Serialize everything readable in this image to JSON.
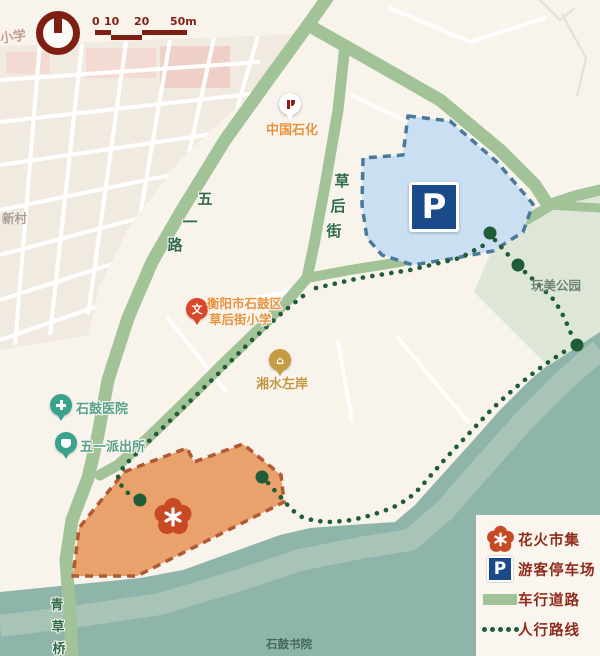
{
  "map_title": "花火市集导览图",
  "compass": {
    "icon": "north-compass"
  },
  "scale_bar": {
    "ticks": [
      "0",
      "10",
      "20",
      "50m"
    ]
  },
  "roads": {
    "wuyi_road": "五一路",
    "caohou_street": "草后街",
    "qingcao_bridge": "青草桥"
  },
  "places": {
    "sinopec": "中国石化",
    "school_line1": "衡阳市石鼓区",
    "school_line2": "草后街小学",
    "riverside_residence": "湘水左岸",
    "hospital": "石鼓医院",
    "police_station": "五一派出所",
    "park": "玩美公园",
    "academy": "石鼓书院",
    "village_fragment": "新村",
    "school_fragment": "小学"
  },
  "markers": {
    "parking_letter": "P"
  },
  "legend": {
    "items": [
      {
        "icon": "flower-icon",
        "label": "花火市集"
      },
      {
        "icon": "parking-icon",
        "label": "游客停车场"
      },
      {
        "icon": "road-icon",
        "label": "车行道路"
      },
      {
        "icon": "footpath-icon",
        "label": "人行路线"
      }
    ]
  },
  "colors": {
    "land": "#F8F3EB",
    "blocks": "#F1EAE0",
    "pink_block": "#F3DAD3",
    "pink_block_deep": "#EFD0C8",
    "road": "#A2C398",
    "river": "#8FB5AA",
    "river_band": "#A7C4B7",
    "park": "#DEE7D7",
    "parking_fill": "#CBDFF2",
    "parking_border": "#49799B",
    "parking_sign": "#1B4A8A",
    "market_fill": "#E9A26B",
    "market_border": "#B05A35",
    "flower": "#C84A24",
    "path_dot": "#1F5C38",
    "road_label": "#2F6B4A",
    "legend_text": "#8E2B1B",
    "scale_color": "#7E1F14",
    "poi_orange": "#E8923F",
    "poi_amber": "#C0973F",
    "poi_teal_text": "#55A18B",
    "pin_red": "#D9472B",
    "pin_teal": "#3AA38D",
    "pin_amber": "#C59B43",
    "park_text": "#72857A",
    "academy_text": "#44685C",
    "faded_text": "#A89F98",
    "pink_text": "#C69D95"
  }
}
